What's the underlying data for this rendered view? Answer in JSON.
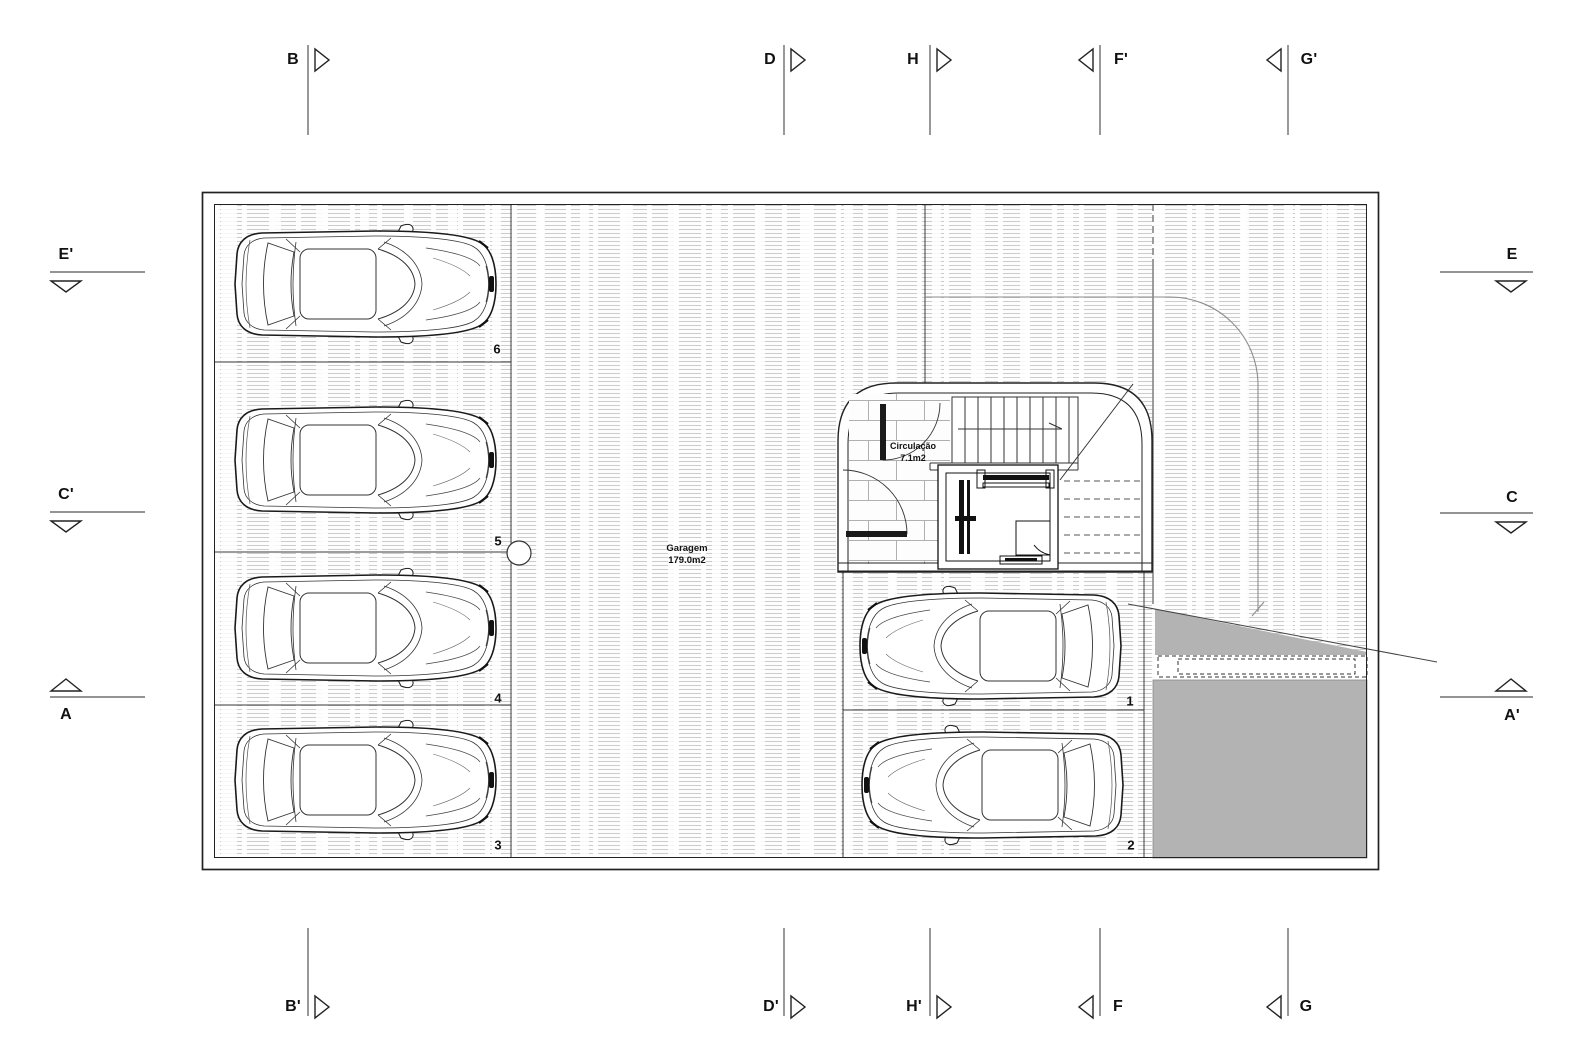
{
  "plan": {
    "garage": {
      "name": "Garagem",
      "area": "179.0m2"
    },
    "circulation": {
      "name": "Circulação",
      "area": "7.1m2"
    },
    "stalls": {
      "s1": "1",
      "s2": "2",
      "s3": "3",
      "s4": "4",
      "s5": "5",
      "s6": "6"
    }
  },
  "markers": {
    "top": {
      "b": "B",
      "d": "D",
      "h": "H",
      "f2": "F'",
      "g2": "G'"
    },
    "bottom": {
      "b2": "B'",
      "d2": "D'",
      "h2": "H'",
      "f": "F",
      "g": "G"
    },
    "left": {
      "e2": "E'",
      "c2": "C'",
      "a": "A"
    },
    "right": {
      "e": "E",
      "c": "C",
      "a2": "A'"
    }
  },
  "colors": {
    "ramp_gray": "#b3b3b3",
    "ink": "#1f1f1f",
    "hatch_line": "#bdbdbd"
  }
}
